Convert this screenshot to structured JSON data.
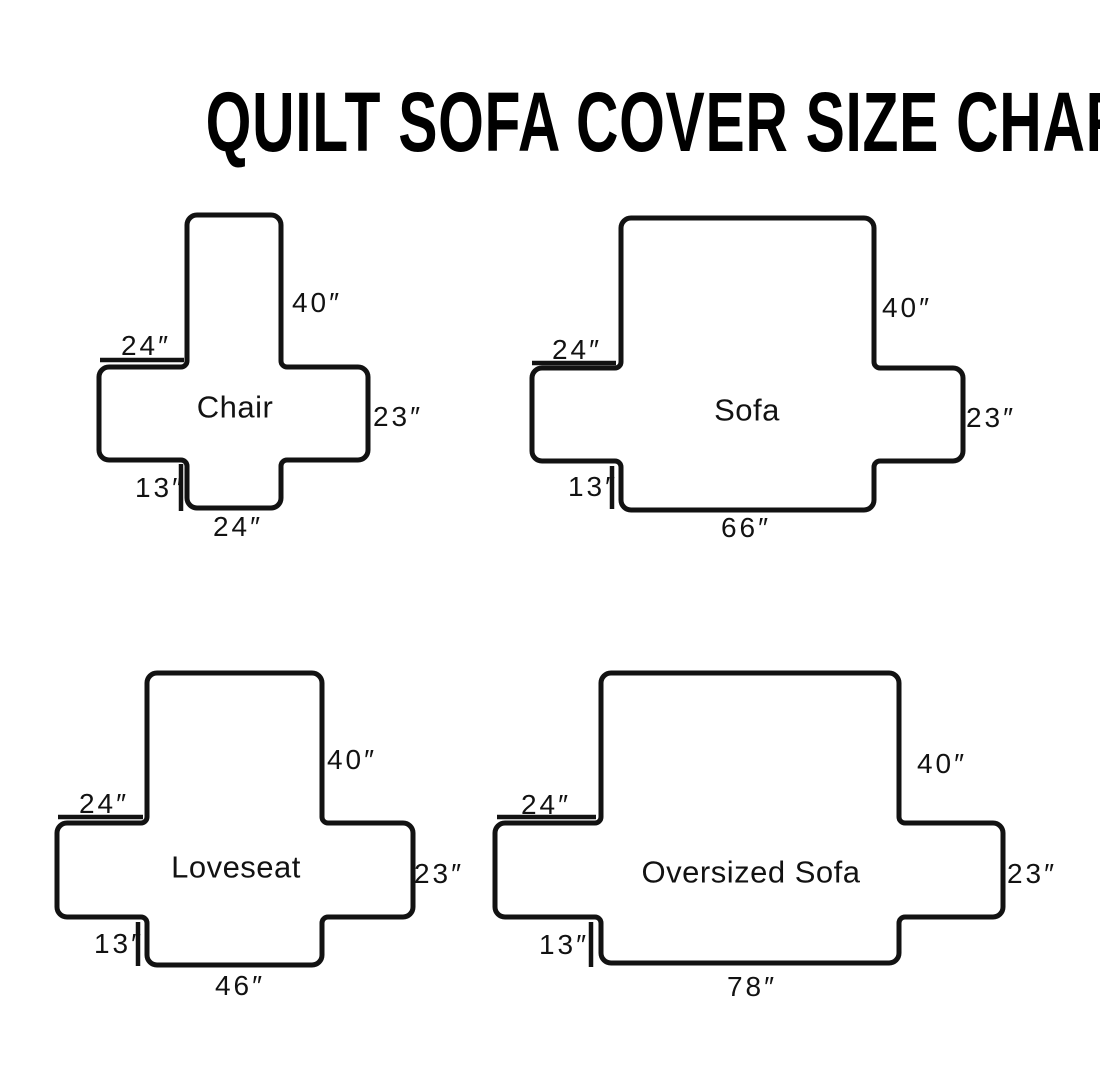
{
  "page": {
    "title": "QUILT SOFA COVER SIZE CHART"
  },
  "colors": {
    "ink": "#121212",
    "background": "#ffffff"
  },
  "diagrams": [
    {
      "id": "chair",
      "name": "Chair",
      "labels": {
        "back_height": "40″",
        "arm_top_width": "24″",
        "side_depth": "23″",
        "front_skirt_height": "13″",
        "seat_width": "24″"
      }
    },
    {
      "id": "sofa",
      "name": "Sofa",
      "labels": {
        "back_height": "40″",
        "arm_top_width": "24″",
        "side_depth": "23″",
        "front_skirt_height": "13″",
        "seat_width": "66″"
      }
    },
    {
      "id": "loveseat",
      "name": "Loveseat",
      "labels": {
        "back_height": "40″",
        "arm_top_width": "24″",
        "side_depth": "23″",
        "front_skirt_height": "13″",
        "seat_width": "46″"
      }
    },
    {
      "id": "oversized-sofa",
      "name": "Oversized Sofa",
      "labels": {
        "back_height": "40″",
        "arm_top_width": "24″",
        "side_depth": "23″",
        "front_skirt_height": "13″",
        "seat_width": "78″"
      }
    }
  ]
}
